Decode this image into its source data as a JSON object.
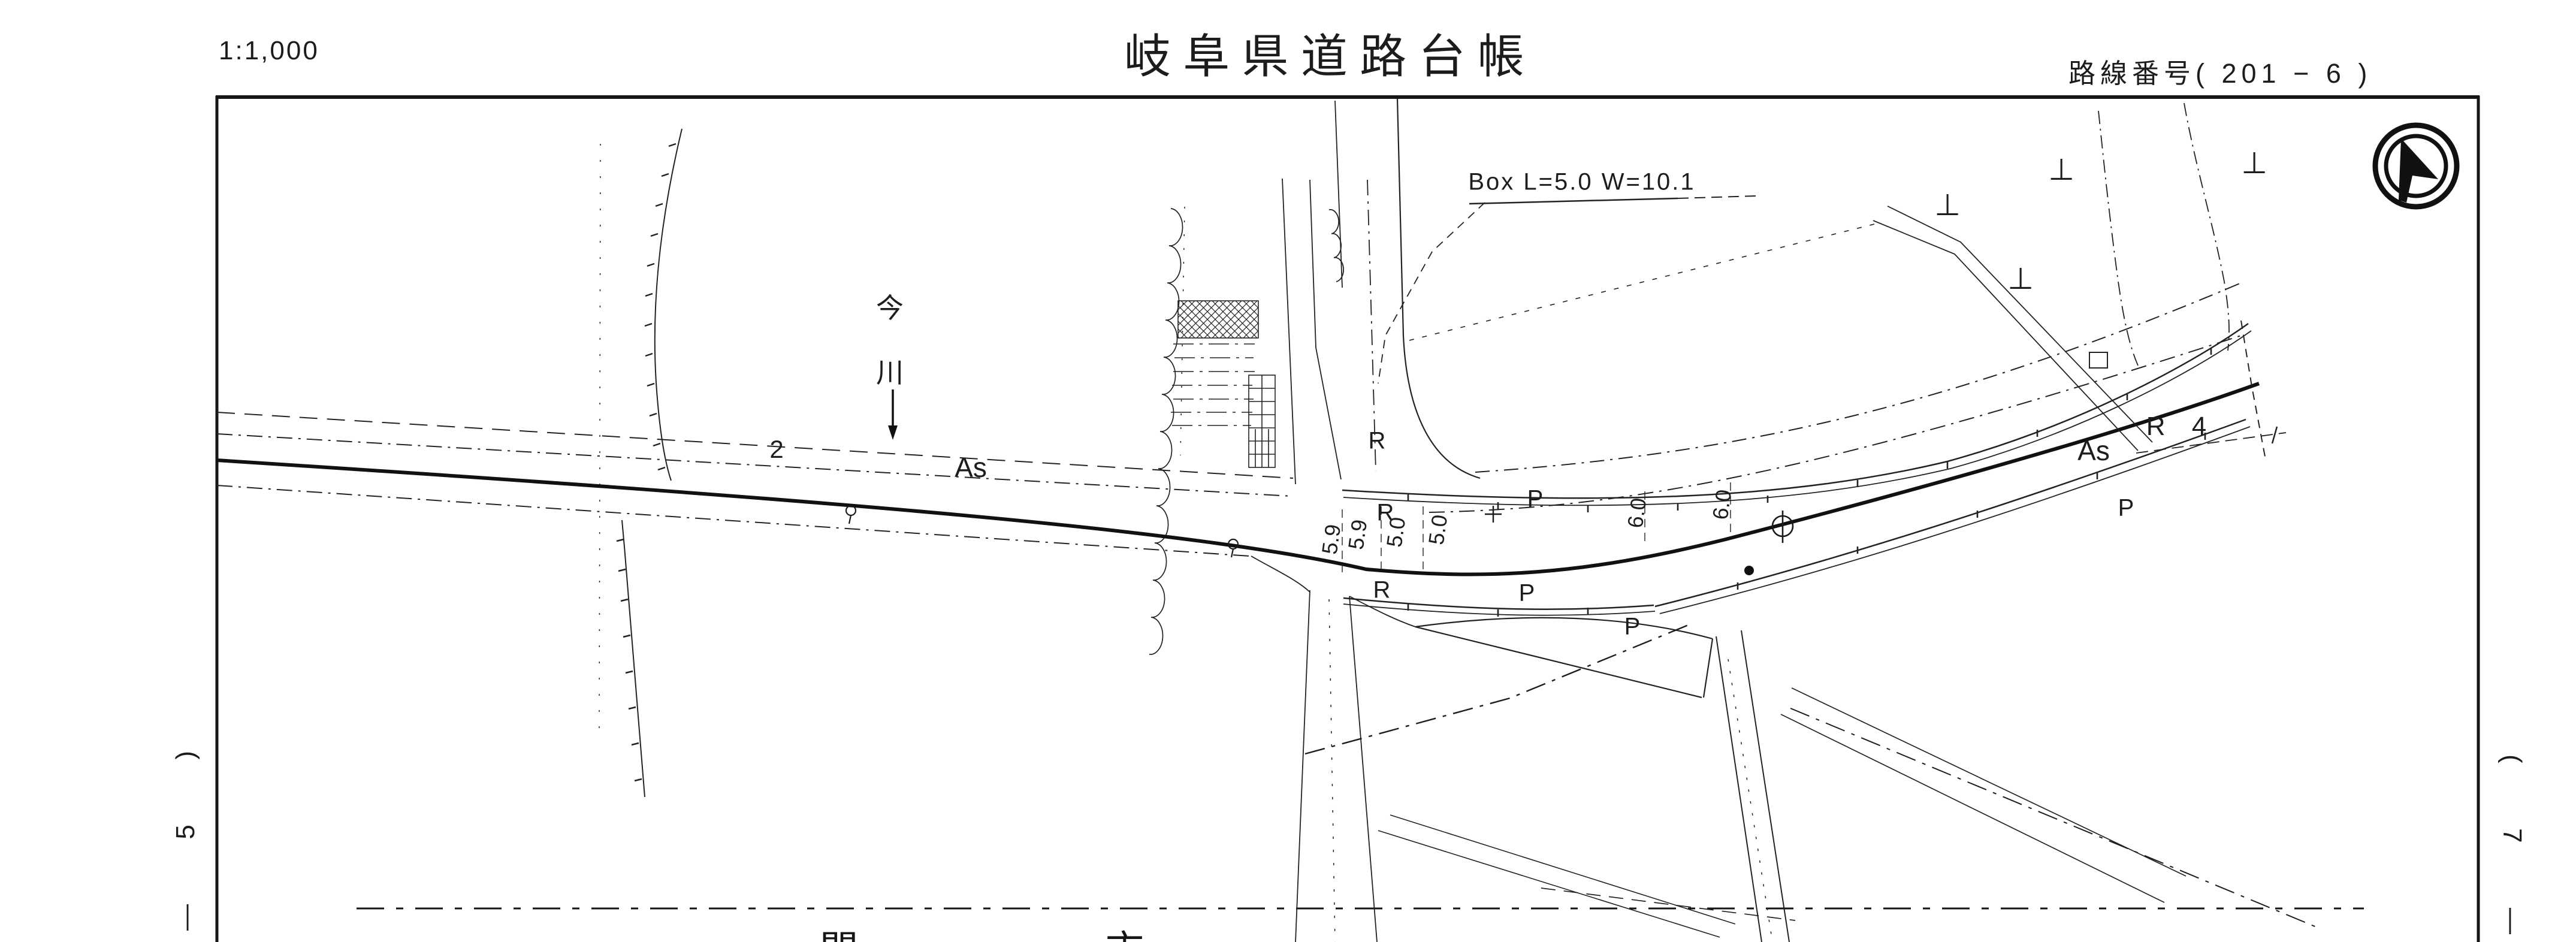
{
  "page": {
    "scale_label": "1:1,000",
    "title": "岐阜県道路台帳",
    "route_number": "路線番号( 201 − 6 )",
    "ink_color": "#1c1c1c",
    "paper_color": "#ffffff"
  },
  "margins": {
    "left_chars": [
      "—",
      "5",
      ")"
    ],
    "right_chars": [
      "(",
      "7",
      "—"
    ],
    "bottom_left_city_char": "関",
    "bottom_right_city_char": "市"
  },
  "map": {
    "structure_note": "Box L=5.0 W=10.1",
    "river_name_chars": [
      "今",
      "川"
    ],
    "lane_number": "2",
    "pavement_west": "As",
    "pavement_east": "As",
    "curve_radius": "R 4",
    "guardrail_marks": [
      "P",
      "P",
      "P",
      "P"
    ],
    "rail_marks": [
      "R",
      "R",
      "R"
    ],
    "width_values": [
      "5.9",
      "5.9",
      "5.0",
      "5.0",
      "6.0",
      "6.0"
    ],
    "pole_symbol": "⊥",
    "symbols": {
      "north_arrow": "compass-north-arrow",
      "manhole": "circled-phi-manhole",
      "survey_cross": "plus-cross",
      "benchmark": "small-circle-with-stem"
    }
  }
}
